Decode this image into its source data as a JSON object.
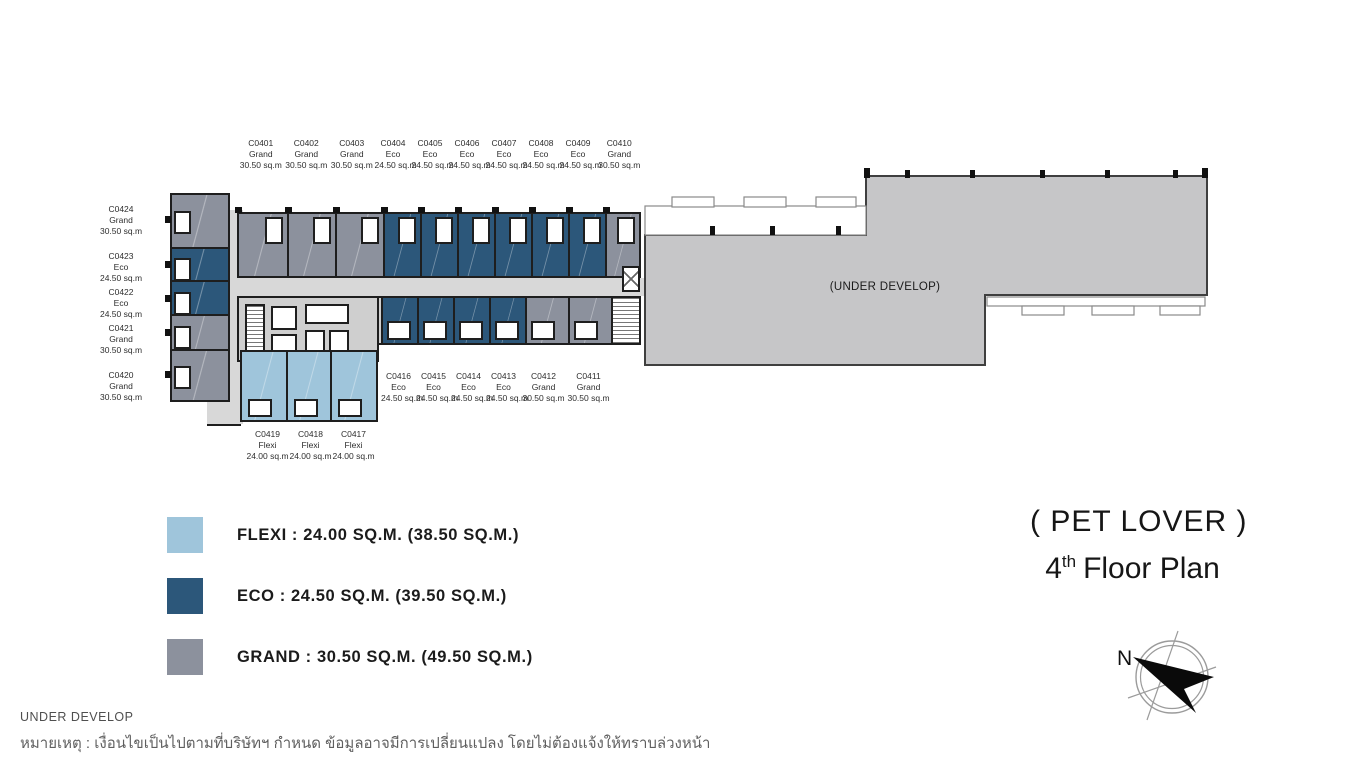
{
  "title": {
    "zone": "( PET LOVER )",
    "floor_number": "4",
    "floor_ordinal": "th",
    "floor_text": "Floor Plan"
  },
  "compass": {
    "north": "N"
  },
  "plan": {
    "under_develop": "(UNDER DEVELOP)",
    "units_top": [
      {
        "code": "C0401",
        "type": "Grand",
        "size": "30.50 sq.m"
      },
      {
        "code": "C0402",
        "type": "Grand",
        "size": "30.50 sq.m"
      },
      {
        "code": "C0403",
        "type": "Grand",
        "size": "30.50 sq.m"
      },
      {
        "code": "C0404",
        "type": "Eco",
        "size": "24.50 sq.m"
      },
      {
        "code": "C0405",
        "type": "Eco",
        "size": "24.50 sq.m"
      },
      {
        "code": "C0406",
        "type": "Eco",
        "size": "24.50 sq.m"
      },
      {
        "code": "C0407",
        "type": "Eco",
        "size": "24.50 sq.m"
      },
      {
        "code": "C0408",
        "type": "Eco",
        "size": "24.50 sq.m"
      },
      {
        "code": "C0409",
        "type": "Eco",
        "size": "24.50 sq.m"
      },
      {
        "code": "C0410",
        "type": "Grand",
        "size": "30.50 sq.m"
      }
    ],
    "units_left": [
      {
        "code": "C0424",
        "type": "Grand",
        "size": "30.50 sq.m"
      },
      {
        "code": "C0423",
        "type": "Eco",
        "size": "24.50 sq.m"
      },
      {
        "code": "C0422",
        "type": "Eco",
        "size": "24.50 sq.m"
      },
      {
        "code": "C0421",
        "type": "Grand",
        "size": "30.50 sq.m"
      },
      {
        "code": "C0420",
        "type": "Grand",
        "size": "30.50 sq.m"
      }
    ],
    "units_bottom": [
      {
        "code": "C0416",
        "type": "Eco",
        "size": "24.50 sq.m"
      },
      {
        "code": "C0415",
        "type": "Eco",
        "size": "24.50 sq.m"
      },
      {
        "code": "C0414",
        "type": "Eco",
        "size": "24.50 sq.m"
      },
      {
        "code": "C0413",
        "type": "Eco",
        "size": "24.50 sq.m"
      },
      {
        "code": "C0412",
        "type": "Grand",
        "size": "30.50 sq.m"
      },
      {
        "code": "C0411",
        "type": "Grand",
        "size": "30.50 sq.m"
      }
    ],
    "units_flexi": [
      {
        "code": "C0419",
        "type": "Flexi",
        "size": "24.00 sq.m"
      },
      {
        "code": "C0418",
        "type": "Flexi",
        "size": "24.00 sq.m"
      },
      {
        "code": "C0417",
        "type": "Flexi",
        "size": "24.00 sq.m"
      }
    ]
  },
  "legend": [
    {
      "type": "Flexi",
      "color": "#9FC5DB",
      "label": "FLEXI : 24.00 SQ.M. (38.50 SQ.M.)"
    },
    {
      "type": "Eco",
      "color": "#2C577A",
      "label": "ECO : 24.50 SQ.M. (39.50 SQ.M.)"
    },
    {
      "type": "Grand",
      "color": "#8C919D",
      "label": "GRAND : 30.50 SQ.M. (49.50 SQ.M.)"
    }
  ],
  "footer": {
    "develop": "UNDER DEVELOP",
    "note": "หมายเหตุ : เงื่อนไขเป็นไปตามที่บริษัทฯ กำหนด ข้อมูลอาจมีการเปลี่ยนแปลง โดยไม่ต้องแจ้งให้ทราบล่วงหน้า"
  },
  "colors": {
    "flexi": "#9FC5DB",
    "eco": "#2C577A",
    "grand": "#8C919D",
    "develop": "#C6C6C8",
    "corridor": "#D8D8D8"
  }
}
